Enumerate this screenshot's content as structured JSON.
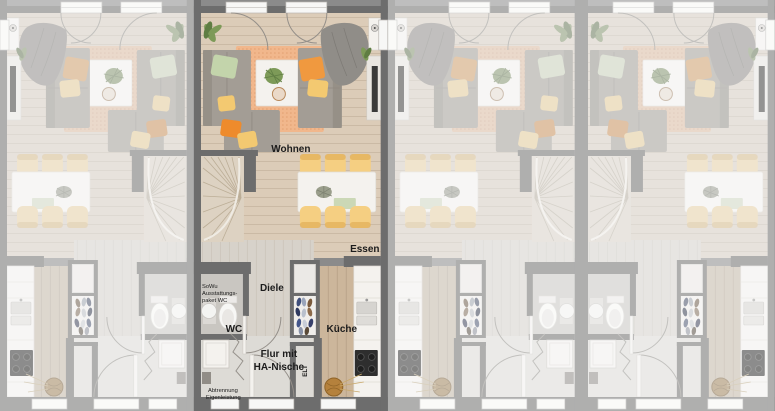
{
  "units": [
    {
      "id": "unit-1",
      "mirrored": true,
      "highlighted": false
    },
    {
      "id": "unit-2",
      "mirrored": false,
      "highlighted": true
    },
    {
      "id": "unit-3",
      "mirrored": true,
      "highlighted": false
    },
    {
      "id": "unit-4",
      "mirrored": false,
      "highlighted": false
    }
  ],
  "labels": {
    "living": "Wohnen",
    "dining": "Essen",
    "hall": "Diele",
    "wc": "WC",
    "kitchen": "Küche",
    "entry1": "Flur mit",
    "entry2": "HA-Nische",
    "elt": "ELT",
    "pkg1": "SoWu",
    "pkg2": "Ausstattungs-",
    "pkg3": "paket WC",
    "part1": "Abtrennung",
    "part2": "Eigenleistung"
  },
  "colors": {
    "bg": "#8b8b8b",
    "wall": "#6d6d6d",
    "floorLiving": "#dcccb8",
    "floorHall": "#d7d2ca",
    "floorWc": "#c9c6c1",
    "floorKitchen": "#ccb69b",
    "stair": "#ddd2c2",
    "rug": "#f1b78c",
    "rugDot": "#e19f70",
    "sofa": "#a39d95",
    "sofaDark": "#8f8880",
    "blanket": "#908d88",
    "white": "#f4f2ee",
    "chair": "#f5cf82",
    "pOrange": "#f0993f",
    "pOrange2": "#ee8b2c",
    "pYellow": "#f3c971",
    "pGreen": "#c3d4ab",
    "plant": "#7d9a58",
    "plantDark": "#5f7d43",
    "tv": "#3a3a3a",
    "cooktop": "#2e2e2e",
    "basket": "#b5813c",
    "win": "#f7f7f6",
    "arc": "#948f89",
    "text": "#1c1c1c",
    "dim": "#e7e7e5"
  }
}
